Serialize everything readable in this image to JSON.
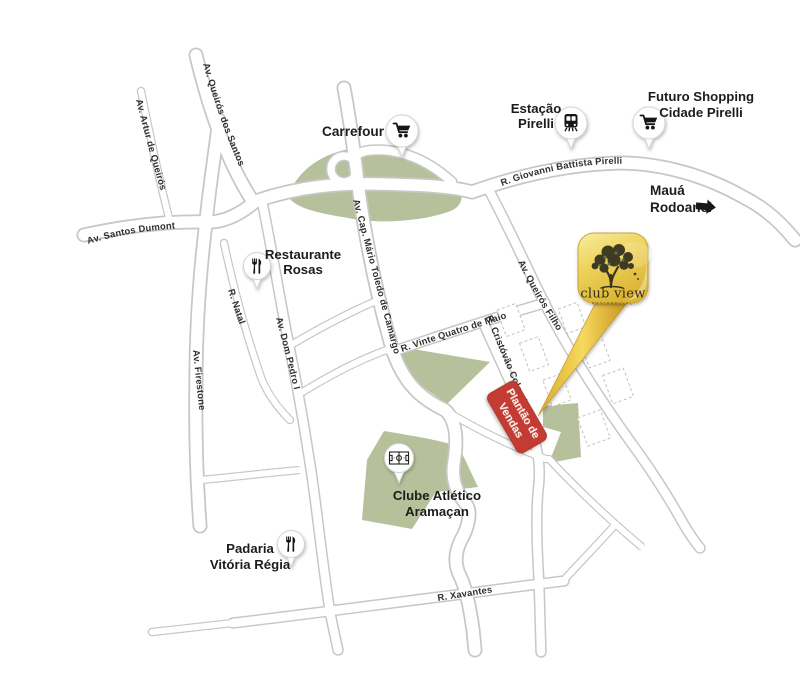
{
  "colors": {
    "background": "#ffffff",
    "green_area": "#b6c19c",
    "road_fill": "#ffffff",
    "road_casing": "#c7c7c5",
    "banner_red": "#c33a31",
    "banner_text": "#fdf6f0",
    "logo_gold": "#eccf52",
    "logo_gold_dark": "#dbb335",
    "logo_text": "#322d18",
    "icon_black": "#181816",
    "label_text": "#1c1c1a"
  },
  "streets": {
    "queiros_dos_santos": "Av. Queirós dos Santos",
    "artur_de_queiros": "Av. Artur de Queirós",
    "santos_dumont": "Av. Santos Dumont",
    "natal": "R. Natal",
    "dom_pedro": "Av. Dom Pedro I",
    "firestone": "Av. Firestone",
    "camargo": "Av. Cap. Mário Toledo de Camargo",
    "vinte_quatro": "R. Vinte Quatro de Maio",
    "cristovao_colombo": "R. Cristóvão Colombo",
    "queiros_filho": "Av. Queirós Filho",
    "giovanni_battista": "R. Giovanni Battista Pirelli",
    "xavantes": "R. Xavantes"
  },
  "pois": {
    "carrefour": {
      "label": "Carrefour",
      "icon": "shopping-cart-icon"
    },
    "estacao_pirelli": {
      "line1": "Estação",
      "line2": "Pirelli",
      "icon": "train-icon"
    },
    "futuro_shopping": {
      "line1": "Futuro Shopping",
      "line2": "Cidade Pirelli",
      "icon": "shopping-cart-icon"
    },
    "maua_rodoanel": {
      "line1": "Mauá",
      "line2": "Rodoanel",
      "icon": "arrow-right-icon"
    },
    "restaurante_rosas": {
      "line1": "Restaurante",
      "line2": "Rosas",
      "icon": "restaurant-icon"
    },
    "padaria_vitoria_regia": {
      "line1": "Padaria",
      "line2": "Vitória Régia",
      "icon": "restaurant-icon"
    },
    "clube_atletico": {
      "line1": "Clube Atlético",
      "line2": "Aramaçan",
      "icon": "soccer-field-icon"
    }
  },
  "logo": {
    "name": "club view",
    "tagline": "RESIDENCIAL"
  },
  "sales_banner": {
    "line1": "Plantão de",
    "line2": "Vendas"
  }
}
